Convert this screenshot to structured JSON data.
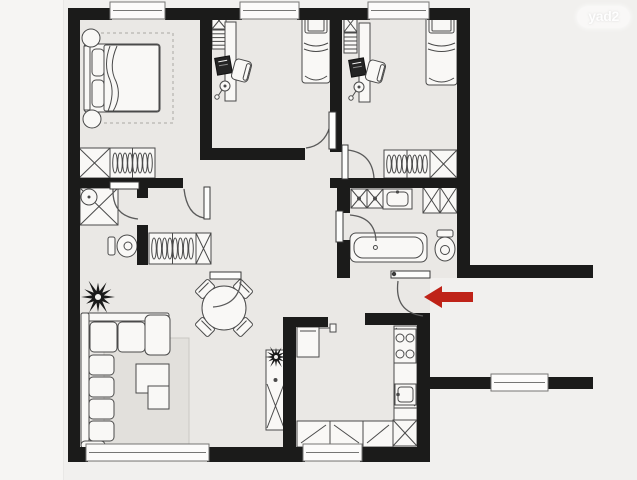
{
  "watermark": {
    "text": "yad2"
  },
  "canvas": {
    "width": 637,
    "height": 480
  },
  "colors": {
    "outside": "#f1f0ee",
    "edge_strip": "#f6f5f3",
    "floor": "#eae8e5",
    "wall": "#1b1b1a",
    "furniture_fill": "#f9f8f6",
    "furniture_stroke": "#4a4a4a",
    "furniture_dark": "#242424",
    "rug": "#e2e0dc",
    "rug_stroke": "#c9c7c3",
    "rug_dash_stroke": "#a9a7a3",
    "window_fill": "#fcfbfa",
    "window_stroke": "#767674",
    "door_fill": "#fdfdfc",
    "door_stroke": "#3a3a3a",
    "door_arc": "#5a5a5a",
    "arrow": "#bf2318",
    "plant": "#1a1a1a"
  },
  "floors": [
    [
      68,
      8,
      402,
      270
    ],
    [
      68,
      265,
      362,
      197
    ]
  ],
  "walls": [
    [
      68,
      8,
      44,
      12
    ],
    [
      165,
      8,
      77,
      12
    ],
    [
      297,
      8,
      73,
      12
    ],
    [
      427,
      8,
      43,
      12
    ],
    [
      68,
      8,
      12,
      454
    ],
    [
      68,
      447,
      20,
      15
    ],
    [
      207,
      447,
      98,
      15
    ],
    [
      360,
      447,
      70,
      15
    ],
    [
      457,
      8,
      13,
      270
    ],
    [
      457,
      265,
      136,
      13
    ],
    [
      200,
      8,
      12,
      144
    ],
    [
      330,
      8,
      12,
      144
    ],
    [
      200,
      148,
      105,
      12
    ],
    [
      330,
      178,
      140,
      10
    ],
    [
      68,
      178,
      115,
      10
    ],
    [
      137,
      188,
      11,
      10
    ],
    [
      137,
      225,
      11,
      40
    ],
    [
      337,
      188,
      13,
      25
    ],
    [
      337,
      240,
      13,
      38
    ],
    [
      283,
      317,
      45,
      10
    ],
    [
      283,
      317,
      13,
      133
    ],
    [
      365,
      313,
      65,
      12
    ],
    [
      417,
      313,
      13,
      149
    ],
    [
      430,
      377,
      63,
      12
    ],
    [
      546,
      377,
      47,
      12
    ]
  ],
  "windows": [
    [
      110,
      2,
      55,
      17
    ],
    [
      240,
      2,
      59,
      17
    ],
    [
      368,
      2,
      61,
      17
    ],
    [
      86,
      444,
      123,
      17
    ],
    [
      303,
      444,
      59,
      17
    ],
    [
      491,
      374,
      57,
      17
    ]
  ],
  "doors": [
    {
      "name": "master-bedroom-door",
      "leaf": [
        204,
        187,
        6,
        32
      ],
      "arc": "M 184 189 Q 187 215 204 218"
    },
    {
      "name": "middle-bedroom-door",
      "leaf": [
        329,
        112,
        7,
        37
      ],
      "arc": "M 332 113 Q 330 145 306 148"
    },
    {
      "name": "right-bedroom-door",
      "leaf": [
        342,
        145,
        6,
        34
      ],
      "arc": "M 348 150 Q 372 153 374 178"
    },
    {
      "name": "shower-room-door",
      "leaf": [
        110,
        182,
        29,
        7
      ],
      "arc": "M 113 189 Q 112 216 138 219"
    },
    {
      "name": "bathroom-door",
      "leaf": [
        336,
        211,
        7,
        31
      ],
      "arc": "M 350 215 Q 375 217 376 241"
    },
    {
      "name": "living-room-door",
      "leaf": [
        210,
        272,
        31,
        7
      ],
      "arc": "M 241 280 Q 239 305 213 307"
    },
    {
      "name": "entrance-door",
      "leaf": [
        391,
        271,
        39,
        7
      ],
      "knob": [
        394,
        274
      ],
      "arc": "M 398 281 Q 394 312 423 316"
    }
  ],
  "furniture": [
    {
      "type": "rug_dashed",
      "name": "master-bedroom-rug",
      "x": 95,
      "y": 33,
      "w": 78,
      "h": 90
    },
    {
      "type": "double_bed",
      "name": "double-bed",
      "x": 84,
      "y": 44,
      "w": 76,
      "h": 68
    },
    {
      "type": "round_stand",
      "name": "nightstand",
      "cx": 91,
      "cy": 38,
      "r": 9
    },
    {
      "type": "round_stand",
      "name": "nightstand",
      "cx": 92,
      "cy": 119,
      "r": 9
    },
    {
      "type": "xbox",
      "name": "closet-box",
      "x": 79,
      "y": 148,
      "w": 31,
      "h": 30
    },
    {
      "type": "hang",
      "name": "hanging-closet",
      "x": 110,
      "y": 148,
      "w": 45,
      "h": 30
    },
    {
      "type": "xbox",
      "name": "shelf-box",
      "x": 212,
      "y": 12,
      "w": 14,
      "h": 17
    },
    {
      "type": "shelf",
      "name": "bookshelf",
      "x": 212,
      "y": 30,
      "w": 14,
      "h": 19
    },
    {
      "type": "desk",
      "name": "desk",
      "x": 225,
      "y": 22,
      "w": 11,
      "h": 79
    },
    {
      "type": "monitor",
      "name": "computer-monitor",
      "x": 216,
      "y": 57,
      "w": 15,
      "h": 17,
      "rot": -10
    },
    {
      "type": "chair",
      "name": "desk-chair",
      "x": 233,
      "y": 60,
      "w": 17,
      "h": 21,
      "rot": 15
    },
    {
      "type": "lamp",
      "name": "desk-lamp",
      "cx": 225,
      "cy": 86,
      "r": 5
    },
    {
      "type": "single_bed",
      "name": "single-bed",
      "x": 302,
      "y": 13,
      "w": 28,
      "h": 70
    },
    {
      "type": "xbox",
      "name": "shelf-box",
      "x": 344,
      "y": 15,
      "w": 13,
      "h": 17
    },
    {
      "type": "shelf",
      "name": "bookshelf",
      "x": 344,
      "y": 33,
      "w": 13,
      "h": 20
    },
    {
      "type": "desk",
      "name": "desk",
      "x": 359,
      "y": 23,
      "w": 11,
      "h": 79
    },
    {
      "type": "monitor",
      "name": "computer-monitor",
      "x": 350,
      "y": 59,
      "w": 15,
      "h": 17,
      "rot": -10
    },
    {
      "type": "chair",
      "name": "desk-chair",
      "x": 367,
      "y": 61,
      "w": 17,
      "h": 21,
      "rot": 15
    },
    {
      "type": "lamp",
      "name": "desk-lamp",
      "cx": 359,
      "cy": 87,
      "r": 5
    },
    {
      "type": "single_bed",
      "name": "single-bed",
      "x": 426,
      "y": 13,
      "w": 31,
      "h": 72
    },
    {
      "type": "hang",
      "name": "hanging-closet",
      "x": 384,
      "y": 150,
      "w": 46,
      "h": 28
    },
    {
      "type": "xbox",
      "name": "closet-box",
      "x": 430,
      "y": 150,
      "w": 27,
      "h": 28
    },
    {
      "type": "shower",
      "name": "shower",
      "x": 80,
      "y": 188,
      "w": 38,
      "h": 37
    },
    {
      "type": "toilet",
      "name": "toilet",
      "x": 108,
      "y": 233,
      "w": 30,
      "h": 26,
      "dir": "h"
    },
    {
      "type": "hang",
      "name": "hanging-closet",
      "x": 149,
      "y": 233,
      "w": 47,
      "h": 31
    },
    {
      "type": "xbox",
      "name": "closet-box",
      "x": 196,
      "y": 233,
      "w": 15,
      "h": 31
    },
    {
      "type": "washers",
      "name": "washing-machines",
      "x": 351,
      "y": 189,
      "w": 32,
      "h": 19
    },
    {
      "type": "bsink",
      "name": "bathroom-sink",
      "x": 383,
      "y": 189,
      "w": 29,
      "h": 20
    },
    {
      "type": "xbox",
      "name": "bathroom-cabinet",
      "x": 423,
      "y": 187,
      "w": 17,
      "h": 26
    },
    {
      "type": "xbox",
      "name": "bathroom-cabinet",
      "x": 440,
      "y": 187,
      "w": 17,
      "h": 26
    },
    {
      "type": "bathtub",
      "name": "bathtub",
      "x": 350,
      "y": 233,
      "w": 77,
      "h": 29
    },
    {
      "type": "toilet",
      "name": "toilet",
      "x": 433,
      "y": 230,
      "w": 24,
      "h": 31,
      "dir": "v"
    },
    {
      "type": "plant",
      "name": "plant",
      "cx": 98,
      "cy": 297,
      "r": 17
    },
    {
      "type": "dining",
      "name": "dining-table",
      "cx": 224,
      "cy": 308,
      "r": 22
    },
    {
      "type": "rug",
      "name": "living-room-rug",
      "x": 104,
      "y": 338,
      "w": 85,
      "h": 106
    },
    {
      "type": "sofa",
      "name": "sofa",
      "x": 81,
      "y": 313
    },
    {
      "type": "coffee_table",
      "name": "coffee-table",
      "x": 136,
      "y": 364
    },
    {
      "type": "cabinet",
      "name": "cabinet",
      "x": 266,
      "y": 350,
      "w": 19,
      "h": 80
    },
    {
      "type": "plant",
      "name": "plant",
      "cx": 276,
      "cy": 357,
      "r": 11
    },
    {
      "type": "fridge",
      "name": "fridge",
      "x": 297,
      "y": 327,
      "w": 22,
      "h": 30
    },
    {
      "type": "counter_col",
      "name": "kitchen-counter",
      "x": 394,
      "y": 326,
      "w": 23,
      "h": 119
    },
    {
      "type": "stove",
      "name": "stove",
      "x": 394,
      "y": 329,
      "w": 22,
      "h": 34
    },
    {
      "type": "ksink",
      "name": "kitchen-sink",
      "x": 395,
      "y": 384,
      "w": 21,
      "h": 21
    },
    {
      "type": "counter_row",
      "name": "kitchen-counter",
      "x": 297,
      "y": 421,
      "w": 96,
      "h": 26
    },
    {
      "type": "xbox",
      "name": "kitchen-cabinet",
      "x": 393,
      "y": 420,
      "w": 24,
      "h": 26
    }
  ],
  "arrow": {
    "points": "424,297 442,286 442,292 473,292 473,302 442,302 442,308"
  }
}
